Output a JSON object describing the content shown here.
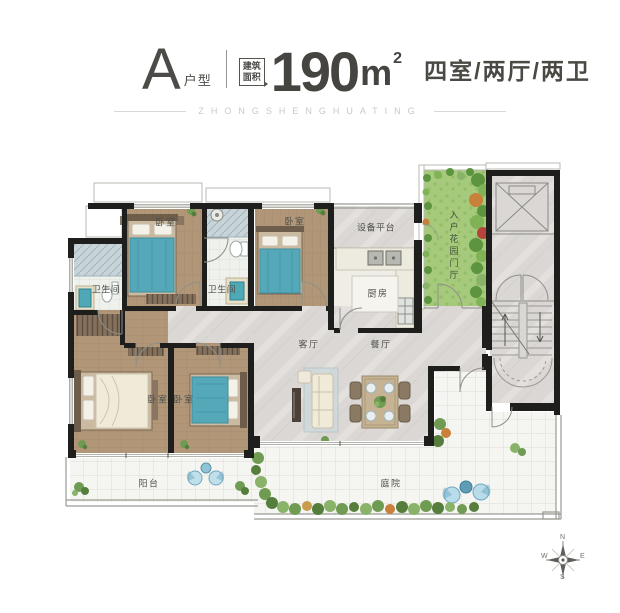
{
  "header": {
    "unit_letter": "A",
    "unit_type_label": "户型",
    "area_caption_top": "建筑",
    "area_caption_bottom": "面积",
    "area_value": "190",
    "area_unit": "m",
    "area_exponent": "2",
    "layout_description": "四室/两厅/两卫"
  },
  "watermark": {
    "text": "ZHONGSHENGHUATING"
  },
  "plan": {
    "rooms": [
      {
        "id": "bedroom-1",
        "label": "卧室"
      },
      {
        "id": "bedroom-2",
        "label": "卧室"
      },
      {
        "id": "bathroom-1",
        "label": "卫生间"
      },
      {
        "id": "bathroom-2",
        "label": "卫生间"
      },
      {
        "id": "equipment-platform",
        "label": "设备平台"
      },
      {
        "id": "kitchen",
        "label": "厨房"
      },
      {
        "id": "entry-garden-foyer",
        "label": "入户花园门厅"
      },
      {
        "id": "living-room",
        "label": "客厅"
      },
      {
        "id": "dining-room",
        "label": "餐厅"
      },
      {
        "id": "bedroom-3",
        "label": "卧室"
      },
      {
        "id": "bedroom-4",
        "label": "卧室"
      },
      {
        "id": "balcony",
        "label": "阳台"
      },
      {
        "id": "courtyard",
        "label": "庭院"
      }
    ],
    "compass": {
      "north": "N",
      "east": "E",
      "south": "S",
      "west": "W"
    },
    "colors": {
      "wall": "#1e1e1c",
      "wood_floor": "#b19778",
      "marble_floor": "#dad7d4",
      "tile_floor": "#f5f5f1",
      "garden_green": "#a6ca7b",
      "accent_teal": "#54a8b8"
    }
  }
}
